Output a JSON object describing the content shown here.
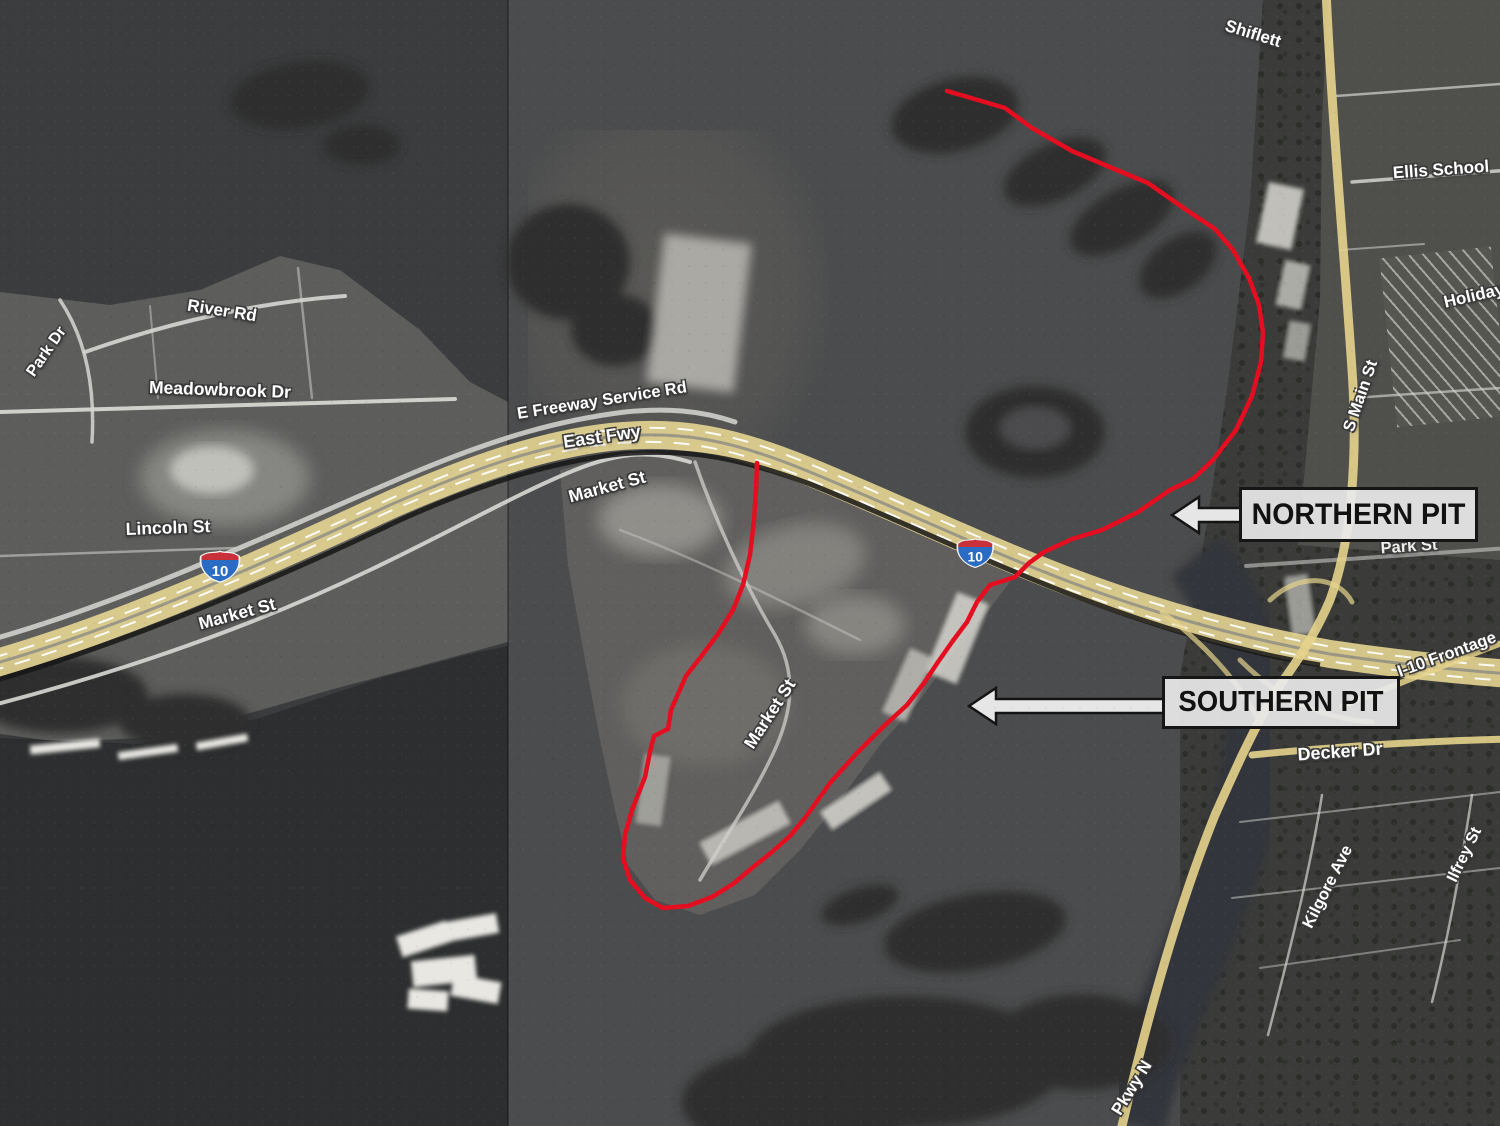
{
  "callouts": {
    "northern_pit": "NORTHERN PIT",
    "southern_pit": "SOUTHERN PIT"
  },
  "interstate_shield": {
    "route": "10"
  },
  "road_labels": [
    {
      "id": "shiflett",
      "text": "Shiflett"
    },
    {
      "id": "ellis-school",
      "text": "Ellis School"
    },
    {
      "id": "holiday",
      "text": "Holiday"
    },
    {
      "id": "river-rd",
      "text": "River Rd"
    },
    {
      "id": "park-dr",
      "text": "Park Dr"
    },
    {
      "id": "meadowbrook-dr",
      "text": "Meadowbrook Dr"
    },
    {
      "id": "e-freeway-service-rd",
      "text": "E Freeway Service Rd"
    },
    {
      "id": "east-fwy",
      "text": "East Fwy"
    },
    {
      "id": "market-st-upper",
      "text": "Market St"
    },
    {
      "id": "lincoln-st",
      "text": "Lincoln St"
    },
    {
      "id": "market-st-lower-left",
      "text": "Market St"
    },
    {
      "id": "market-st-peninsula",
      "text": "Market St"
    },
    {
      "id": "s-main-st",
      "text": "S Main St"
    },
    {
      "id": "park-st",
      "text": "Park St"
    },
    {
      "id": "i10-frontage",
      "text": "I-10 Frontage"
    },
    {
      "id": "decker-dr",
      "text": "Decker Dr"
    },
    {
      "id": "kilgore-ave",
      "text": "Kilgore Ave"
    },
    {
      "id": "ilfrey-st",
      "text": "Ilfrey St"
    },
    {
      "id": "pkwy-n",
      "text": "Pkwy N"
    }
  ],
  "colors": {
    "pit_outline_red": "#e50d20",
    "freeway_yellow": "#e9d894",
    "callout_background": "#ebebeb",
    "callout_border": "#161616",
    "shield_blue": "#2a6cc4",
    "shield_red": "#c8303a"
  }
}
